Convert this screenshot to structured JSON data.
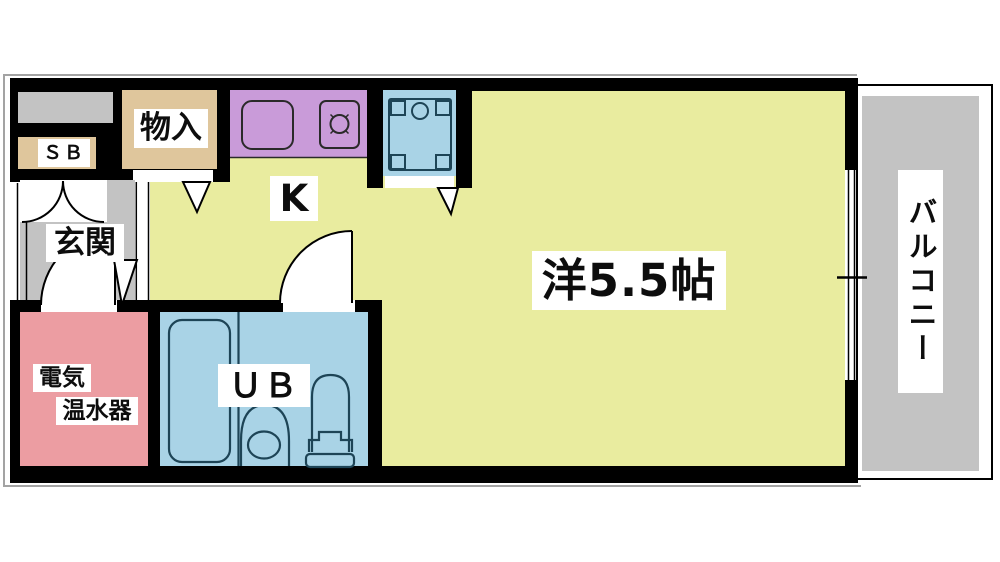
{
  "plan": {
    "title": "apartment-floor-plan",
    "labels": {
      "shoe_box": "ＳＢ",
      "storage": "物入",
      "kitchen": "K",
      "entrance": "玄関",
      "main_room": "洋5.5帖",
      "unit_bath": "ＵＢ",
      "water_heater_line1": "電気",
      "water_heater_line2": "温水器",
      "balcony": "バルコニー"
    },
    "colors": {
      "room_yellow": "#e9ec9f",
      "floor_gray": "#c3c3c3",
      "closet_tan": "#dfc69c",
      "counter_purple": "#c99bd9",
      "bath_blue": "#a9d3e6",
      "heater_pink": "#ec9da2",
      "wall_black": "#000000",
      "fixture_stroke": "#1d4456",
      "shadow_gray": "#a3a3a3"
    },
    "fixtures": [
      "kitchen-sink",
      "stove-burner",
      "washer-pan",
      "bathtub",
      "toilet",
      "vanity-sink",
      "sliding-window",
      "entrance-door",
      "closet-double-doors",
      "water-heater-door",
      "unit-bath-door"
    ]
  }
}
